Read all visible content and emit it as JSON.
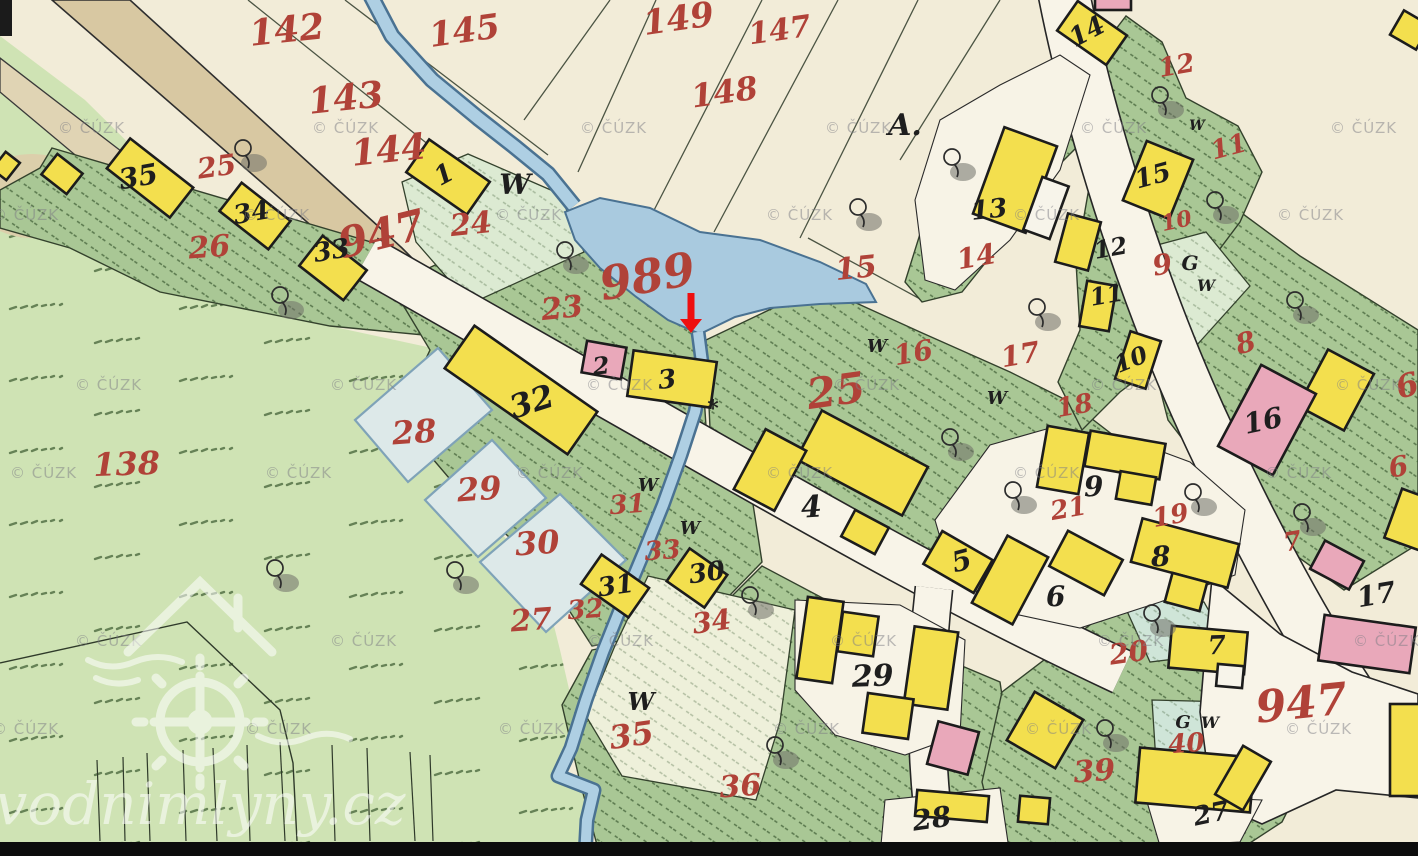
{
  "page": {
    "background": "#f2ecd8"
  },
  "colors": {
    "cream": "#f2ecd8",
    "meadow_green": "#cfe3b4",
    "hatched_green": "#a9c795",
    "mint_plot": "#dcead2",
    "teal_plot": "#cfe5d8",
    "pale_plot": "#eef0da",
    "pond_blue": "#dde9e9",
    "stream_blue": "#aecfe3",
    "stream_edge": "#4a7292",
    "building_yellow": "#f3df4e",
    "building_pink": "#e9a8ba",
    "road_white": "#f8f4e8",
    "road_tan": "#d8c8a2",
    "label_red": "#b04238",
    "label_black": "#1e1e1e",
    "arrow_red": "#ee0f0f",
    "watermark_gray": "#7e7e85",
    "logo_white": "#ffffff"
  },
  "watermark": {
    "text": "© ČÚZK",
    "rows": [
      {
        "y": 133,
        "xs": [
          58,
          312,
          580,
          825,
          1080,
          1330
        ]
      },
      {
        "y": 220,
        "xs": [
          -8,
          243,
          495,
          766,
          1013,
          1277
        ]
      },
      {
        "y": 390,
        "xs": [
          75,
          330,
          586,
          833,
          1090,
          1335
        ]
      },
      {
        "y": 478,
        "xs": [
          10,
          265,
          516,
          766,
          1013,
          1265
        ]
      },
      {
        "y": 646,
        "xs": [
          75,
          330,
          587,
          830,
          1097,
          1353
        ]
      },
      {
        "y": 734,
        "xs": [
          -8,
          245,
          498,
          773,
          1025,
          1285
        ]
      }
    ]
  },
  "logo": {
    "text": "vodnimlyny.cz"
  },
  "highlight_arrow": {
    "x": 691,
    "y_top": 293,
    "y_tip": 333
  },
  "map": {
    "label_format": "[text, x, y, font_size, rotation_deg]",
    "parcel_labels_red": [
      [
        "142",
        288,
        42,
        36,
        -6
      ],
      [
        "143",
        347,
        110,
        36,
        -6
      ],
      [
        "144",
        390,
        162,
        36,
        -6
      ],
      [
        "145",
        466,
        42,
        34,
        -8
      ],
      [
        "149",
        680,
        30,
        34,
        -8
      ],
      [
        "147",
        781,
        40,
        30,
        -8
      ],
      [
        "148",
        726,
        103,
        32,
        -8
      ],
      [
        "989",
        650,
        292,
        46,
        -10
      ],
      [
        "947",
        385,
        248,
        42,
        -14
      ],
      [
        "947",
        1303,
        718,
        44,
        -6
      ],
      [
        "24",
        472,
        234,
        30,
        -6
      ],
      [
        "23",
        563,
        318,
        30,
        -6
      ],
      [
        "25",
        218,
        176,
        28,
        -8
      ],
      [
        "26",
        210,
        257,
        30,
        -4
      ],
      [
        "25",
        838,
        405,
        42,
        -8
      ],
      [
        "16",
        915,
        362,
        28,
        -10
      ],
      [
        "17",
        1022,
        364,
        28,
        -10
      ],
      [
        "15",
        857,
        278,
        30,
        -6
      ],
      [
        "14",
        978,
        266,
        28,
        -10
      ],
      [
        "12",
        1178,
        74,
        26,
        -10
      ],
      [
        "11",
        1231,
        155,
        26,
        -15
      ],
      [
        "10",
        1178,
        228,
        22,
        -12
      ],
      [
        "9",
        1164,
        274,
        28,
        -10
      ],
      [
        "18",
        1076,
        414,
        26,
        -10
      ],
      [
        "8",
        1248,
        352,
        28,
        -15
      ],
      [
        "6",
        1410,
        396,
        32,
        -15
      ],
      [
        "6",
        1400,
        476,
        28,
        -10
      ],
      [
        "7",
        1294,
        550,
        26,
        -10
      ],
      [
        "21",
        1070,
        517,
        26,
        -10
      ],
      [
        "19",
        1172,
        524,
        26,
        -10
      ],
      [
        "20",
        1130,
        662,
        28,
        -8
      ],
      [
        "28",
        415,
        443,
        32,
        -4
      ],
      [
        "29",
        480,
        500,
        32,
        -4
      ],
      [
        "30",
        538,
        554,
        32,
        -4
      ],
      [
        "31",
        628,
        513,
        26,
        -4
      ],
      [
        "33",
        663,
        559,
        26,
        -4
      ],
      [
        "32",
        586,
        618,
        26,
        -4
      ],
      [
        "27",
        532,
        630,
        30,
        -4
      ],
      [
        "34",
        713,
        631,
        28,
        -8
      ],
      [
        "35",
        633,
        746,
        32,
        -8
      ],
      [
        "36",
        741,
        796,
        30,
        -4
      ],
      [
        "138",
        127,
        475,
        32,
        -2
      ],
      [
        "39",
        1095,
        781,
        30,
        -4
      ],
      [
        "40",
        1187,
        752,
        26,
        -4
      ]
    ],
    "house_labels_black": [
      [
        "35",
        140,
        186,
        28,
        -10
      ],
      [
        "34",
        253,
        221,
        26,
        -10
      ],
      [
        "33",
        333,
        259,
        26,
        -10
      ],
      [
        "1",
        448,
        182,
        26,
        -28
      ],
      [
        "2",
        602,
        374,
        24,
        -6
      ],
      [
        "3",
        668,
        388,
        26,
        -6
      ],
      [
        "32",
        535,
        412,
        32,
        -18
      ],
      [
        "4",
        812,
        517,
        30,
        -4
      ],
      [
        "5",
        964,
        570,
        28,
        -15
      ],
      [
        "6",
        1056,
        606,
        28,
        -2
      ],
      [
        "8",
        1161,
        566,
        28,
        -2
      ],
      [
        "9",
        1094,
        496,
        28,
        -2
      ],
      [
        "7",
        1217,
        654,
        26,
        -2
      ],
      [
        "29",
        873,
        686,
        30,
        -2
      ],
      [
        "28",
        933,
        828,
        28,
        -8
      ],
      [
        "27",
        1213,
        822,
        26,
        -12
      ],
      [
        "13",
        990,
        218,
        26,
        -6
      ],
      [
        "14",
        1091,
        39,
        26,
        -28
      ],
      [
        "15",
        1155,
        184,
        26,
        -15
      ],
      [
        "12",
        1112,
        256,
        24,
        -10
      ],
      [
        "11",
        1108,
        303,
        24,
        -10
      ],
      [
        "10",
        1134,
        367,
        24,
        -22
      ],
      [
        "16",
        1265,
        430,
        28,
        -12
      ],
      [
        "17",
        1378,
        604,
        28,
        -10
      ],
      [
        "31",
        617,
        594,
        26,
        -8
      ],
      [
        "30",
        708,
        581,
        26,
        -8
      ]
    ],
    "letter_marks_black": [
      [
        "A.",
        905,
        135,
        30,
        0
      ],
      [
        "G",
        1190,
        270,
        20,
        0
      ],
      [
        "G",
        1183,
        728,
        18,
        0
      ],
      [
        "*",
        713,
        416,
        22,
        0
      ]
    ],
    "meadow_marks_w": [
      [
        515,
        194,
        28
      ],
      [
        877,
        352,
        18
      ],
      [
        997,
        404,
        18
      ],
      [
        648,
        491,
        18
      ],
      [
        690,
        534,
        18
      ],
      [
        641,
        710,
        24
      ],
      [
        1197,
        130,
        14
      ],
      [
        1206,
        291,
        16
      ],
      [
        1210,
        728,
        16
      ]
    ]
  }
}
